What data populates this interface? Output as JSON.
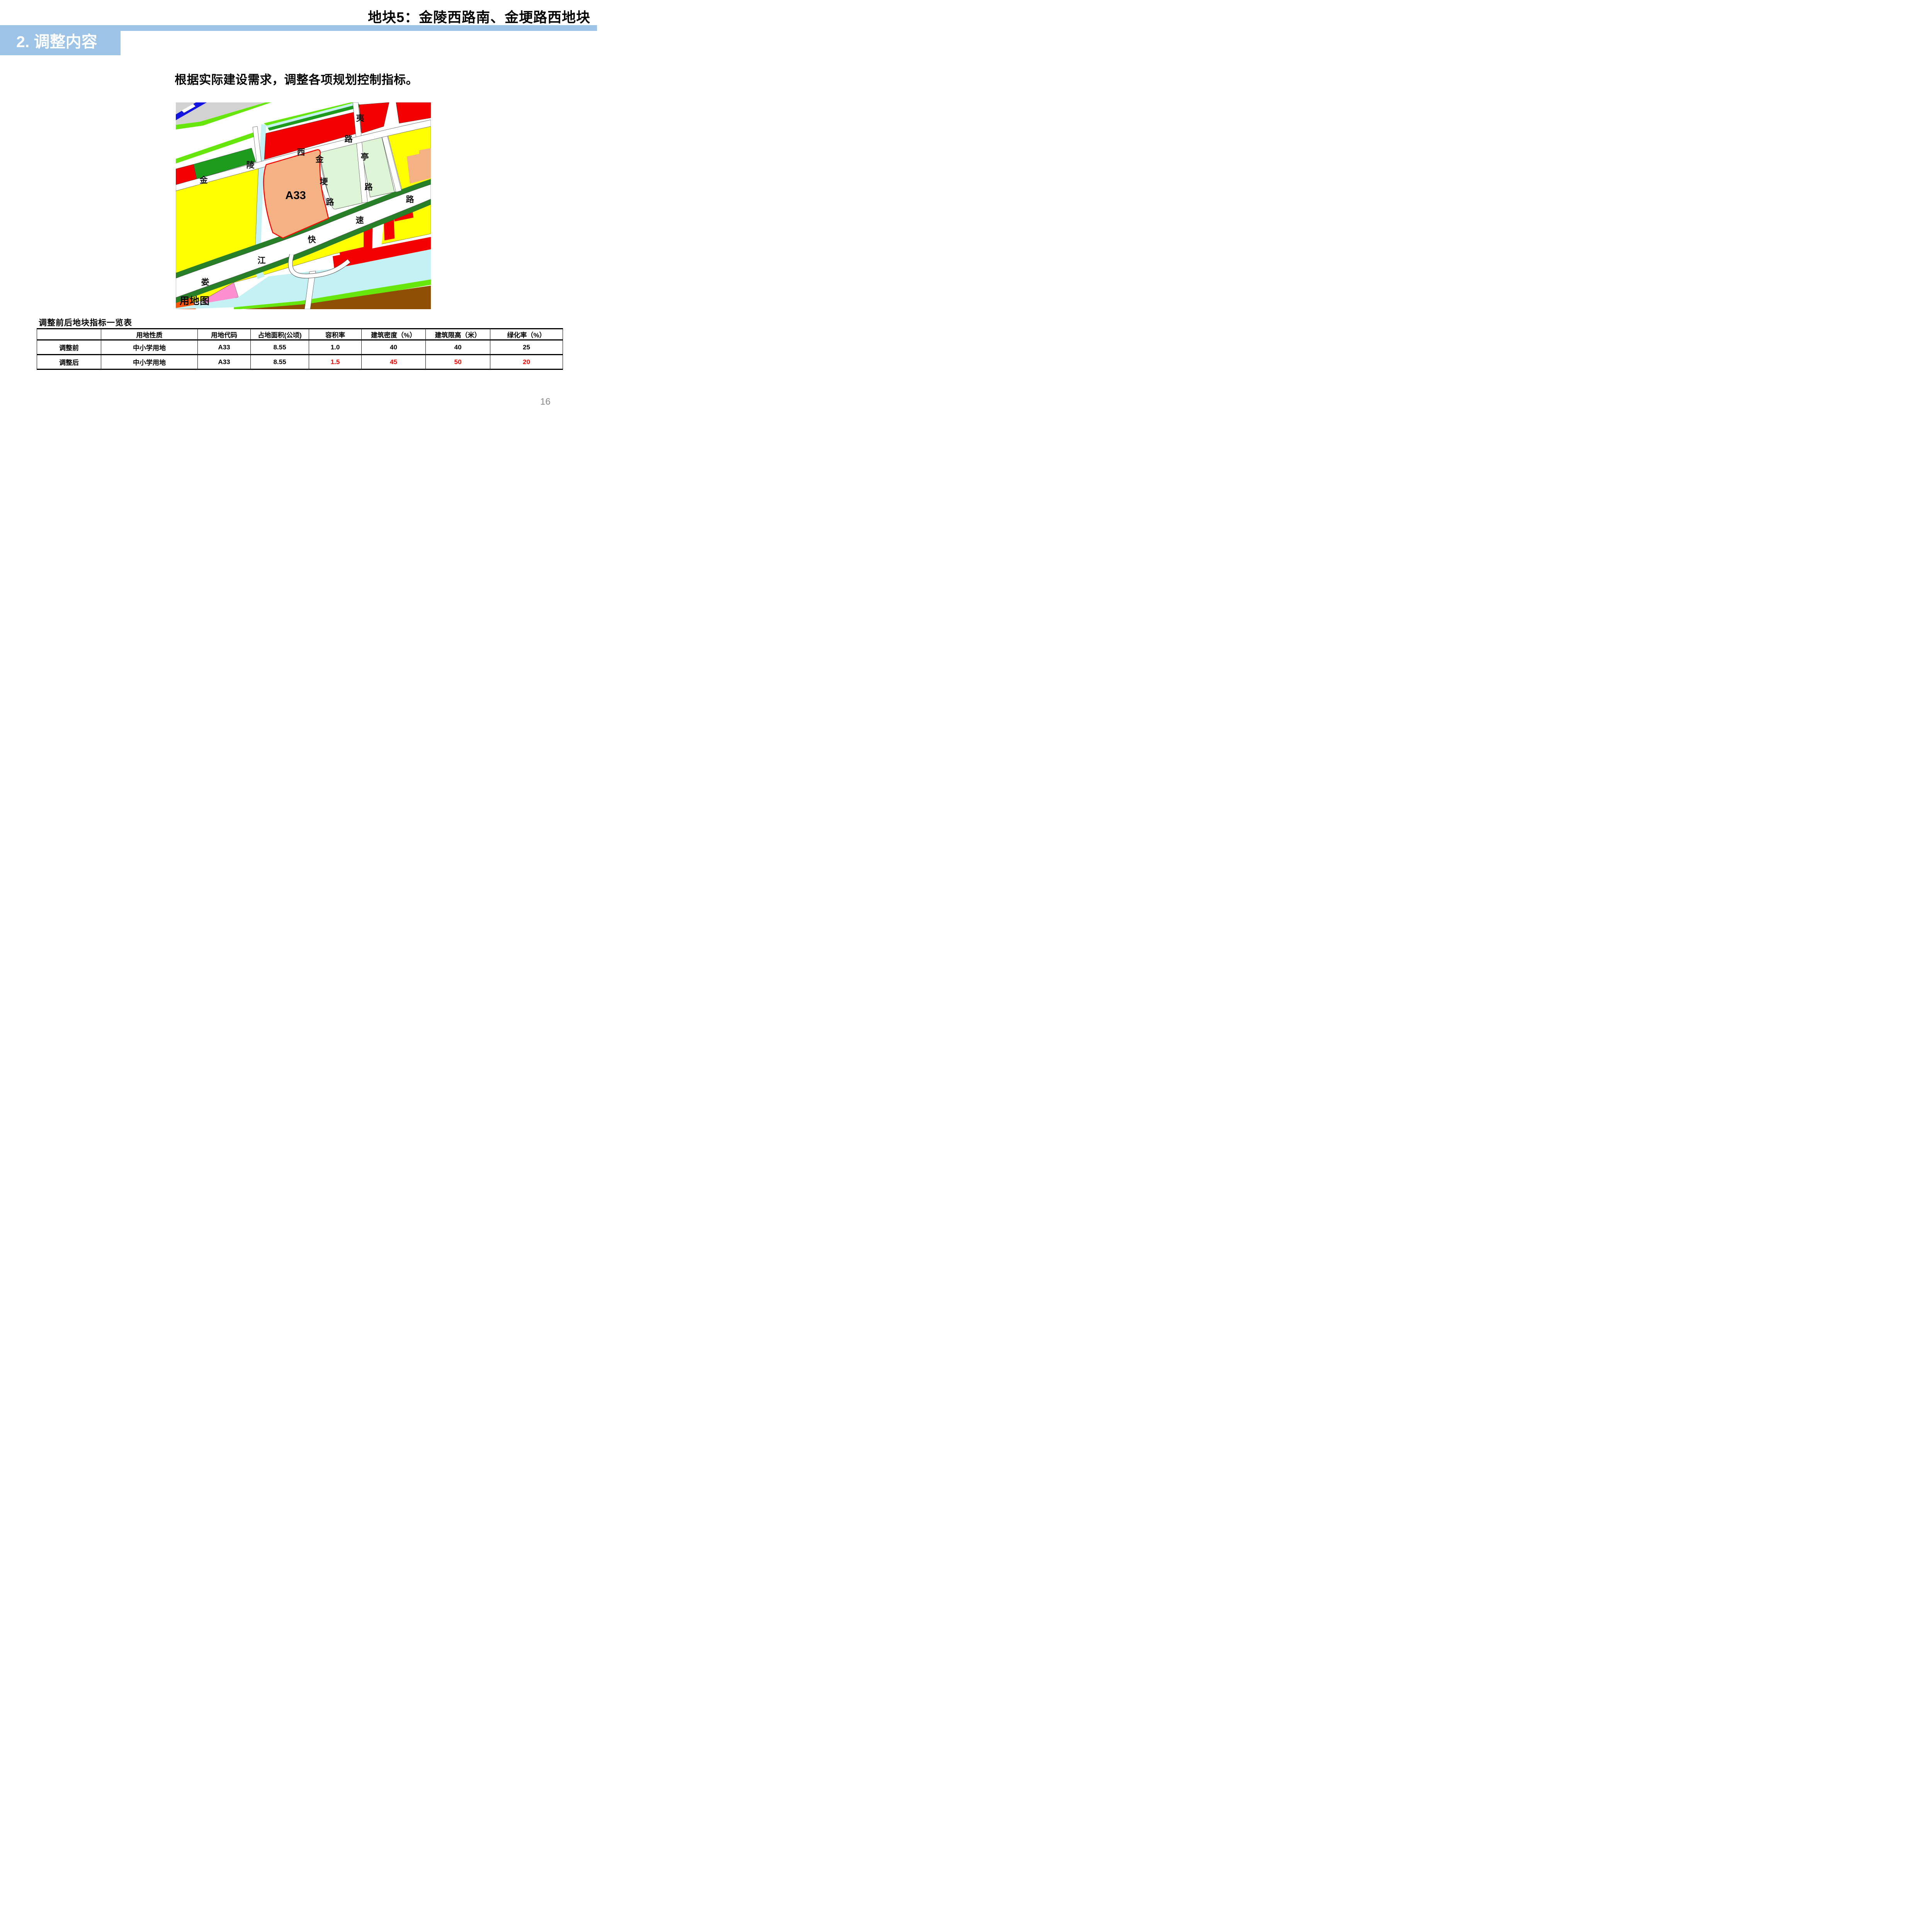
{
  "header": {
    "title": "地块5：金陵西路南、金埂路西地块"
  },
  "section": {
    "title": "2. 调整内容"
  },
  "body": {
    "text": "根据实际建设需求，调整各项规划控制指标。"
  },
  "map": {
    "caption": "用地图",
    "plot_label": "A33",
    "roads": {
      "jinling_west_road": {
        "name": "金陵西路",
        "chars": [
          "金",
          "陵",
          "西",
          "路"
        ]
      },
      "yiting_road": {
        "name": "夷亭路",
        "chars": [
          "夷",
          "亭",
          "路"
        ]
      },
      "jingeng_road": {
        "name": "金埂路",
        "chars": [
          "金",
          "埂",
          "路"
        ]
      },
      "loujiang_expressway": {
        "name": "娄江快速路",
        "chars": [
          "娄",
          "江",
          "快",
          "速",
          "路"
        ]
      }
    },
    "legend_colors": {
      "plot_fill_orange": "#F4B183",
      "plot_border_red": "#FF0000",
      "residential_yellow": "#FFFF00",
      "commercial_red": "#F40000",
      "school_pale_green": "#DFF5D8",
      "park_dark_green": "#1D9B1D",
      "greenway_bright_green": "#66E60A",
      "water_cyan": "#C4F1F3",
      "rail_blue": "#1414E0",
      "industry_brown": "#8E4E04",
      "pink": "#FB8FD0",
      "orange_red": "#F85306",
      "gray": "#D2D2D2"
    }
  },
  "table": {
    "title": "调整前后地块指标一览表",
    "headers": [
      "",
      "用地性质",
      "用地代码",
      "占地面积(公顷)",
      "容积率",
      "建筑密度（%）",
      "建筑限高（米）",
      "绿化率（%）"
    ],
    "rows": [
      {
        "label": "调整前",
        "land_use": "中小学用地",
        "code": "A33",
        "area": "8.55",
        "far": "1.0",
        "density": "40",
        "height_limit": "40",
        "green_rate": "25"
      },
      {
        "label": "调整后",
        "land_use": "中小学用地",
        "code": "A33",
        "area": "8.55",
        "far": "1.5",
        "density": "45",
        "height_limit": "50",
        "green_rate": "20"
      }
    ]
  },
  "footer": {
    "page_number": "16"
  },
  "colors": {
    "accent_blue": "#9DC3E6",
    "changed_value_red": "#FF0000",
    "page_number_gray": "#8a8a8a"
  }
}
